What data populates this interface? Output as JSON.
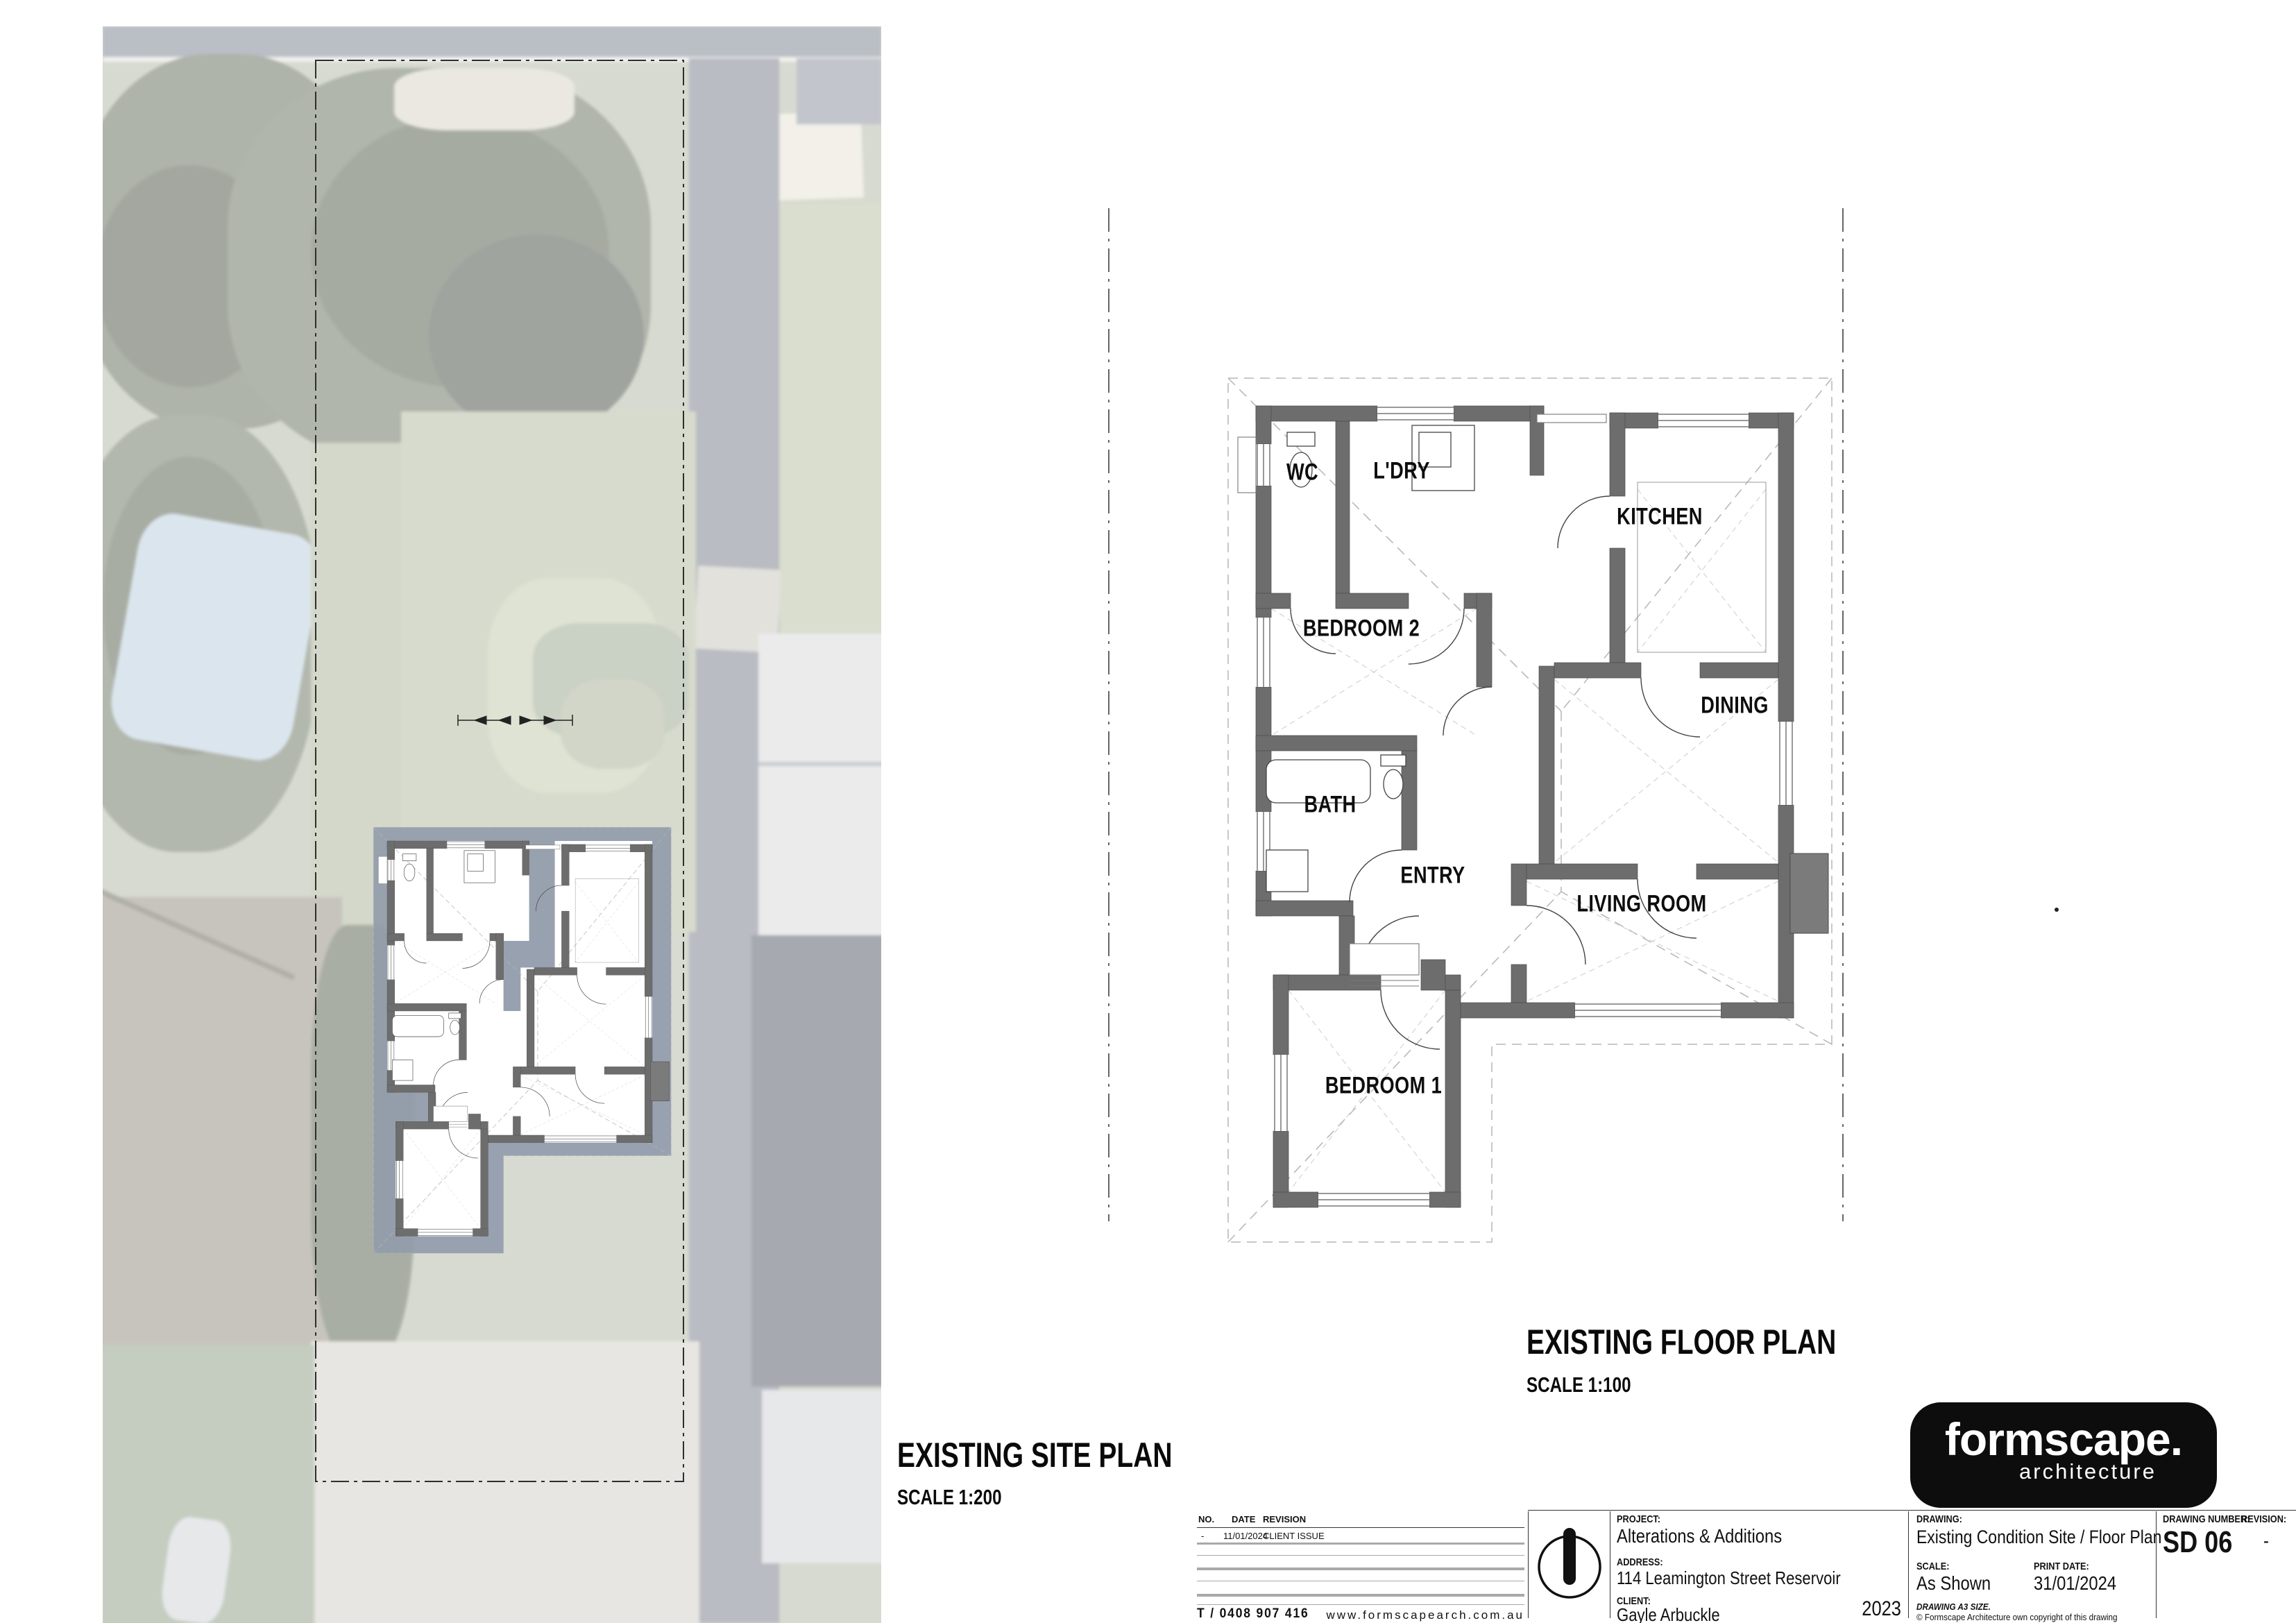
{
  "site_plan": {
    "title": "EXISTING SITE PLAN",
    "scale": "SCALE 1:200"
  },
  "floor_plan": {
    "title": "EXISTING FLOOR PLAN",
    "scale": "SCALE 1:100",
    "rooms": [
      {
        "label": "WC"
      },
      {
        "label": "L'DRY"
      },
      {
        "label": "KITCHEN"
      },
      {
        "label": "BEDROOM 2"
      },
      {
        "label": "DINING"
      },
      {
        "label": "BATH"
      },
      {
        "label": "ENTRY"
      },
      {
        "label": "LIVING ROOM"
      },
      {
        "label": "BEDROOM 1"
      }
    ]
  },
  "title_block": {
    "revision_table": {
      "headers": [
        "NO.",
        "DATE",
        "REVISION"
      ],
      "rows": [
        {
          "no": "-",
          "date": "11/01/2024",
          "revision": "CLIENT ISSUE"
        }
      ]
    },
    "phone": "T / 0408 907 416",
    "website": "www.formscapearch.com.au",
    "project_label": "PROJECT:",
    "project": "Alterations & Additions",
    "address_label": "ADDRESS:",
    "address": "114 Leamington Street Reservoir",
    "client_label": "CLIENT:",
    "client": "Gayle Arbuckle",
    "year": "2023",
    "drawing_label": "DRAWING:",
    "drawing": "Existing Condition Site / Floor Plan",
    "scale_label": "SCALE:",
    "scale": "As Shown",
    "print_date_label": "PRINT DATE:",
    "print_date": "31/01/2024",
    "size_note": "DRAWING A3 SIZE.",
    "copyright": "© Formscape Architecture own copyright of this drawing",
    "drawing_number_label": "DRAWING NUMBER:",
    "drawing_number": "SD 06",
    "revision_label": "REVISION:",
    "revision": "-",
    "logo": {
      "name": "formscape.",
      "sub": "architecture",
      "bg": "#0d0d0d"
    }
  },
  "colors": {
    "wall": "#6d6d6d",
    "roof_overlay": "#939cab",
    "boundary": "#2e2e2e",
    "logo_bg": "#0d0d0d"
  }
}
